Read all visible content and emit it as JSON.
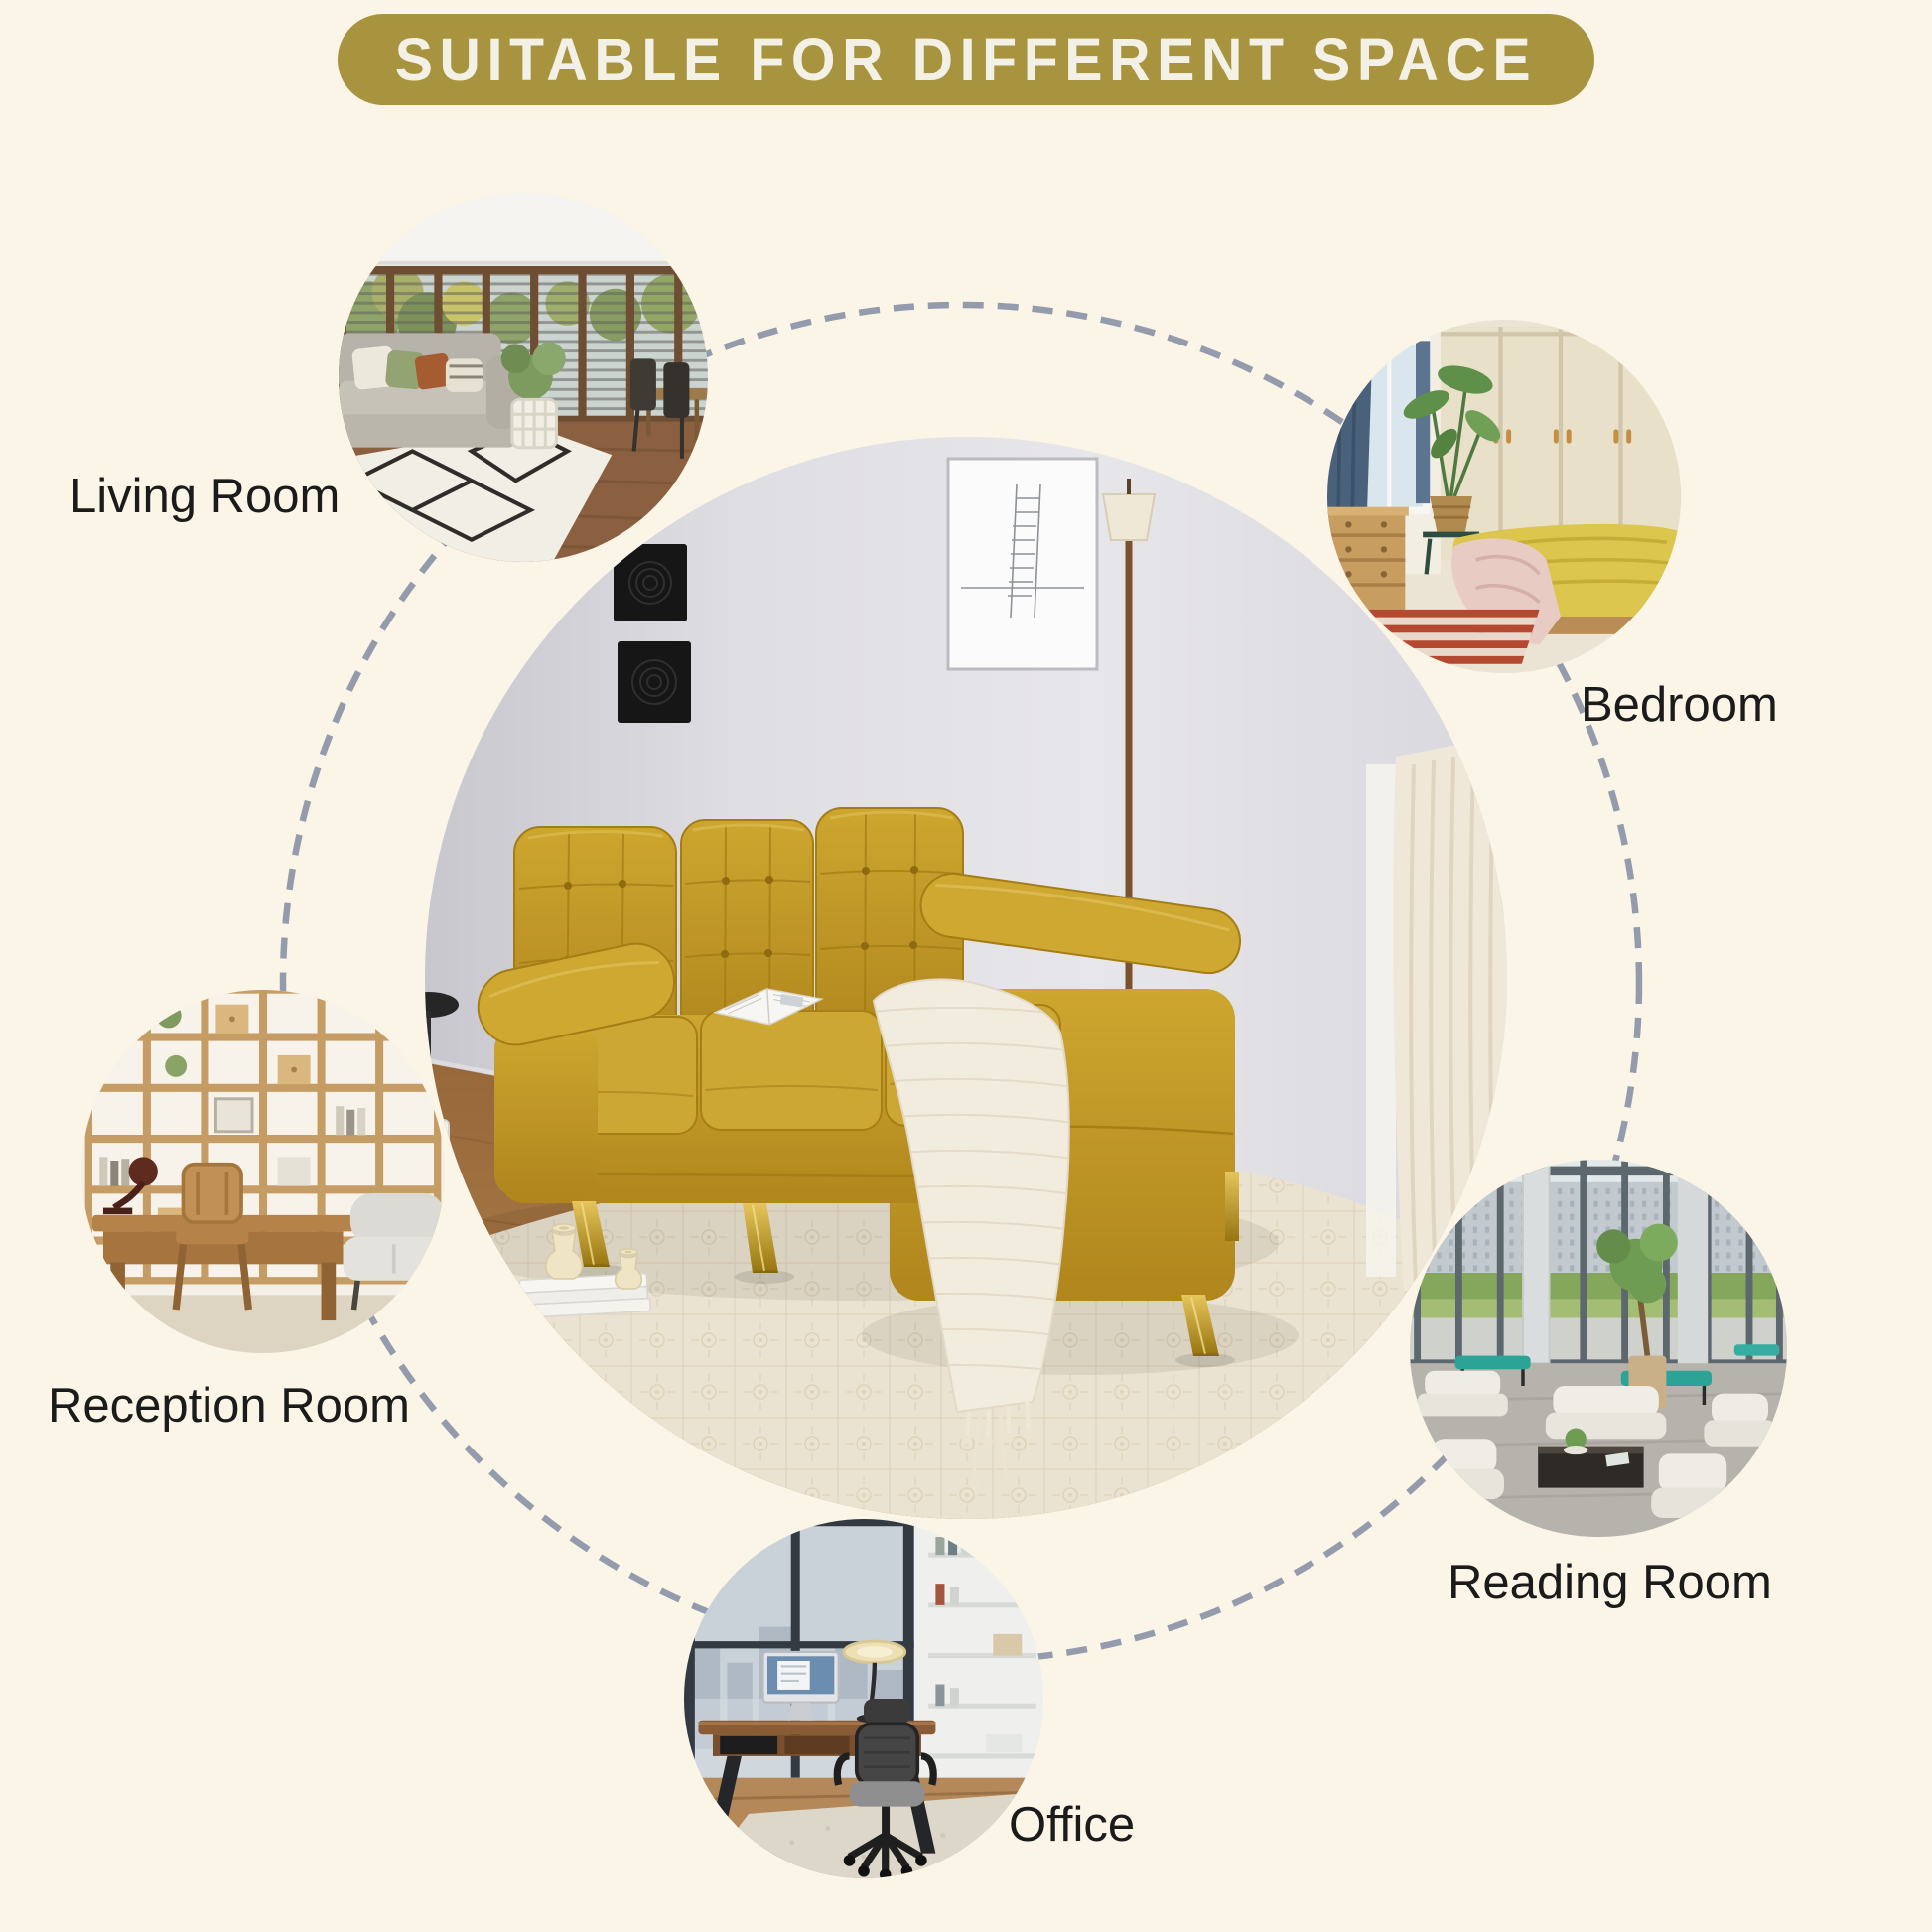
{
  "title": {
    "text": "SUITABLE FOR DIFFERENT SPACE"
  },
  "colors": {
    "background": "#faf5e7",
    "banner": "#a8943f",
    "banner_text": "#f3f0e5",
    "label_text": "#1b1b1b",
    "dash": "#949bad",
    "sofa_yellow": "#c7a02c",
    "rug_cream": "#ebe3d1",
    "wall_gray": "#dfdee3",
    "wood_floor": "#a9743f"
  },
  "rooms": [
    {
      "label": "Living Room"
    },
    {
      "label": "Bedroom"
    },
    {
      "label": "Reception Room"
    },
    {
      "label": "Reading Room"
    },
    {
      "label": "Office"
    }
  ]
}
